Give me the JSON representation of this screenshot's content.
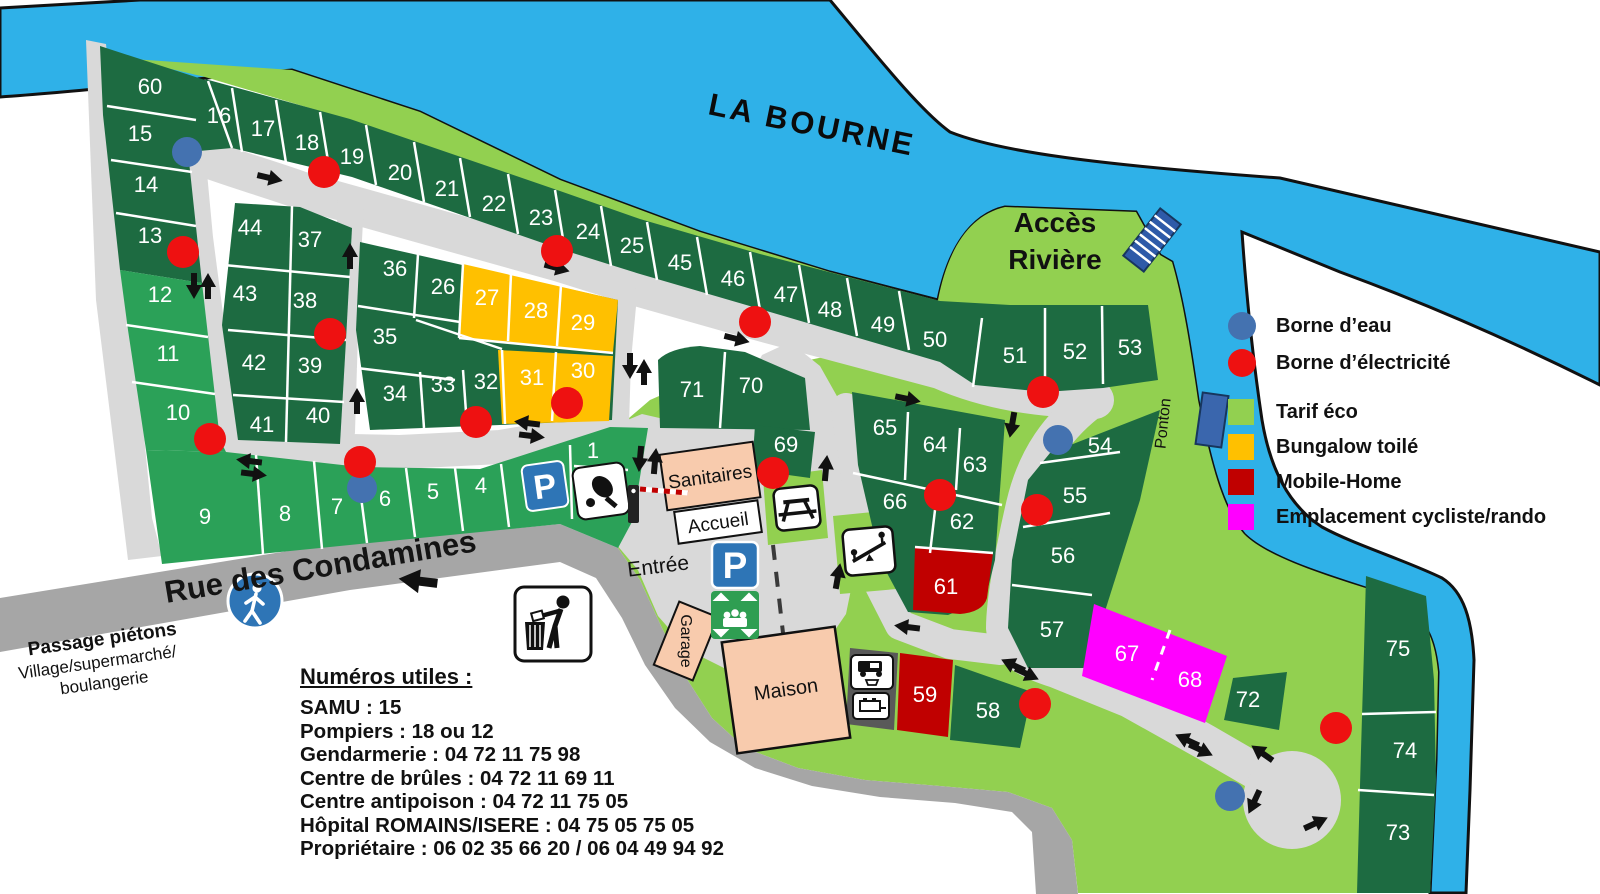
{
  "map": {
    "river_name": "LA BOURNE",
    "river_access_line1": "Accès",
    "river_access_line2": "Rivière",
    "ponton_label": "Ponton",
    "street_name": "Rue des Condamines",
    "pedestrian_crossing_title": "Passage piétons",
    "pedestrian_crossing_line1": "Village/supermarché/",
    "pedestrian_crossing_line2": "boulangerie",
    "entrance_label": "Entrée",
    "buildings": {
      "sanitaires": "Sanitaires",
      "accueil": "Accueil",
      "garage": "Garage",
      "maison": "Maison"
    }
  },
  "legend": {
    "items": [
      {
        "label": "Borne d’eau",
        "shape": "circle",
        "color": "#4472b0"
      },
      {
        "label": "Borne d’électricité",
        "shape": "circle",
        "color": "#ee1111"
      },
      {
        "label": "Tarif éco",
        "shape": "square",
        "color": "#92d050"
      },
      {
        "label": "Bungalow toilé",
        "shape": "square",
        "color": "#ffc000"
      },
      {
        "label": "Mobile-Home",
        "shape": "square",
        "color": "#c00000"
      },
      {
        "label": "Emplacement cycliste/rando",
        "shape": "square",
        "color": "#ff00ff"
      }
    ]
  },
  "useful_numbers": {
    "title": "Numéros utiles :",
    "lines": [
      "SAMU : 15",
      "Pompiers : 18 ou 12",
      "Gendarmerie : 04 72 11 75 98",
      "Centre de brûles : 04 72 11 69 11",
      "Centre antipoison : 04 72 11 75 05",
      "Hôpital ROMAINS/ISERE : 04 75 05 75 05",
      "Propriétaire : 06 02 35 66 20 / 06 04 49 94 92"
    ]
  },
  "plots": [
    {
      "n": "1",
      "x": 593,
      "y": 458,
      "category": "medium"
    },
    {
      "n": "4",
      "x": 481,
      "y": 493,
      "category": "medium"
    },
    {
      "n": "5",
      "x": 433,
      "y": 499,
      "category": "medium"
    },
    {
      "n": "6",
      "x": 385,
      "y": 506,
      "category": "medium"
    },
    {
      "n": "7",
      "x": 337,
      "y": 514,
      "category": "medium"
    },
    {
      "n": "8",
      "x": 285,
      "y": 521,
      "category": "medium"
    },
    {
      "n": "9",
      "x": 205,
      "y": 524,
      "category": "medium"
    },
    {
      "n": "10",
      "x": 178,
      "y": 420,
      "category": "medium"
    },
    {
      "n": "11",
      "x": 168,
      "y": 361,
      "category": "medium"
    },
    {
      "n": "12",
      "x": 160,
      "y": 302,
      "category": "medium"
    },
    {
      "n": "13",
      "x": 150,
      "y": 243,
      "category": "standard"
    },
    {
      "n": "14",
      "x": 146,
      "y": 192,
      "category": "standard"
    },
    {
      "n": "15",
      "x": 140,
      "y": 141,
      "category": "standard"
    },
    {
      "n": "16",
      "x": 219,
      "y": 123,
      "category": "standard"
    },
    {
      "n": "17",
      "x": 263,
      "y": 136,
      "category": "standard"
    },
    {
      "n": "18",
      "x": 307,
      "y": 150,
      "category": "standard"
    },
    {
      "n": "19",
      "x": 352,
      "y": 164,
      "category": "standard"
    },
    {
      "n": "20",
      "x": 400,
      "y": 180,
      "category": "standard"
    },
    {
      "n": "21",
      "x": 447,
      "y": 196,
      "category": "standard"
    },
    {
      "n": "22",
      "x": 494,
      "y": 211,
      "category": "standard"
    },
    {
      "n": "23",
      "x": 541,
      "y": 225,
      "category": "standard"
    },
    {
      "n": "24",
      "x": 588,
      "y": 239,
      "category": "standard"
    },
    {
      "n": "25",
      "x": 632,
      "y": 253,
      "category": "standard"
    },
    {
      "n": "26",
      "x": 443,
      "y": 294,
      "category": "standard"
    },
    {
      "n": "27",
      "x": 487,
      "y": 305,
      "category": "bungalow"
    },
    {
      "n": "28",
      "x": 536,
      "y": 318,
      "category": "bungalow"
    },
    {
      "n": "29",
      "x": 583,
      "y": 330,
      "category": "bungalow"
    },
    {
      "n": "30",
      "x": 583,
      "y": 378,
      "category": "bungalow"
    },
    {
      "n": "31",
      "x": 532,
      "y": 385,
      "category": "bungalow"
    },
    {
      "n": "32",
      "x": 486,
      "y": 389,
      "category": "standard"
    },
    {
      "n": "33",
      "x": 443,
      "y": 392,
      "category": "standard"
    },
    {
      "n": "34",
      "x": 395,
      "y": 401,
      "category": "standard"
    },
    {
      "n": "35",
      "x": 385,
      "y": 344,
      "category": "standard"
    },
    {
      "n": "36",
      "x": 395,
      "y": 276,
      "category": "standard"
    },
    {
      "n": "37",
      "x": 310,
      "y": 247,
      "category": "standard"
    },
    {
      "n": "38",
      "x": 305,
      "y": 308,
      "category": "standard"
    },
    {
      "n": "39",
      "x": 310,
      "y": 373,
      "category": "standard"
    },
    {
      "n": "40",
      "x": 318,
      "y": 423,
      "category": "standard"
    },
    {
      "n": "41",
      "x": 262,
      "y": 432,
      "category": "standard"
    },
    {
      "n": "42",
      "x": 254,
      "y": 370,
      "category": "standard"
    },
    {
      "n": "43",
      "x": 245,
      "y": 301,
      "category": "standard"
    },
    {
      "n": "44",
      "x": 250,
      "y": 235,
      "category": "standard"
    },
    {
      "n": "45",
      "x": 680,
      "y": 270,
      "category": "standard"
    },
    {
      "n": "46",
      "x": 733,
      "y": 286,
      "category": "standard"
    },
    {
      "n": "47",
      "x": 786,
      "y": 302,
      "category": "standard"
    },
    {
      "n": "48",
      "x": 830,
      "y": 317,
      "category": "standard"
    },
    {
      "n": "49",
      "x": 883,
      "y": 332,
      "category": "standard"
    },
    {
      "n": "50",
      "x": 935,
      "y": 347,
      "category": "standard"
    },
    {
      "n": "51",
      "x": 1015,
      "y": 363,
      "category": "standard"
    },
    {
      "n": "52",
      "x": 1075,
      "y": 359,
      "category": "standard"
    },
    {
      "n": "53",
      "x": 1130,
      "y": 355,
      "category": "standard"
    },
    {
      "n": "54",
      "x": 1100,
      "y": 453,
      "category": "standard"
    },
    {
      "n": "55",
      "x": 1075,
      "y": 503,
      "category": "standard"
    },
    {
      "n": "56",
      "x": 1063,
      "y": 563,
      "category": "standard"
    },
    {
      "n": "57",
      "x": 1052,
      "y": 637,
      "category": "standard"
    },
    {
      "n": "58",
      "x": 988,
      "y": 718,
      "category": "standard"
    },
    {
      "n": "59",
      "x": 925,
      "y": 702,
      "category": "mobile"
    },
    {
      "n": "60",
      "x": 150,
      "y": 94,
      "category": "standard"
    },
    {
      "n": "61",
      "x": 946,
      "y": 594,
      "category": "mobile"
    },
    {
      "n": "62",
      "x": 962,
      "y": 529,
      "category": "standard"
    },
    {
      "n": "63",
      "x": 975,
      "y": 472,
      "category": "standard"
    },
    {
      "n": "64",
      "x": 935,
      "y": 452,
      "category": "standard"
    },
    {
      "n": "65",
      "x": 885,
      "y": 435,
      "category": "standard"
    },
    {
      "n": "66",
      "x": 895,
      "y": 509,
      "category": "standard"
    },
    {
      "n": "67",
      "x": 1127,
      "y": 661,
      "category": "cyclo"
    },
    {
      "n": "68",
      "x": 1190,
      "y": 687,
      "category": "cyclo"
    },
    {
      "n": "69",
      "x": 786,
      "y": 452,
      "category": "standard"
    },
    {
      "n": "70",
      "x": 751,
      "y": 393,
      "category": "standard"
    },
    {
      "n": "71",
      "x": 692,
      "y": 397,
      "category": "standard"
    },
    {
      "n": "72",
      "x": 1248,
      "y": 707,
      "category": "standard"
    },
    {
      "n": "73",
      "x": 1398,
      "y": 840,
      "category": "standard"
    },
    {
      "n": "74",
      "x": 1405,
      "y": 758,
      "category": "standard"
    },
    {
      "n": "75",
      "x": 1398,
      "y": 656,
      "category": "standard"
    }
  ],
  "water_points": [
    {
      "x": 187,
      "y": 152
    },
    {
      "x": 362,
      "y": 488
    },
    {
      "x": 1058,
      "y": 440
    },
    {
      "x": 1230,
      "y": 796
    }
  ],
  "electric_points": [
    {
      "x": 324,
      "y": 172
    },
    {
      "x": 183,
      "y": 252
    },
    {
      "x": 557,
      "y": 251
    },
    {
      "x": 755,
      "y": 322
    },
    {
      "x": 1043,
      "y": 392
    },
    {
      "x": 330,
      "y": 334
    },
    {
      "x": 567,
      "y": 403
    },
    {
      "x": 476,
      "y": 422
    },
    {
      "x": 210,
      "y": 439
    },
    {
      "x": 360,
      "y": 462
    },
    {
      "x": 773,
      "y": 473
    },
    {
      "x": 940,
      "y": 495
    },
    {
      "x": 1037,
      "y": 510
    },
    {
      "x": 1035,
      "y": 704
    },
    {
      "x": 1336,
      "y": 728
    }
  ],
  "colors": {
    "river": "#2fb1e8",
    "grass": "#92d050",
    "plot_standard": "#1d6b41",
    "plot_medium": "#2ba158",
    "plot_bungalow": "#ffc000",
    "plot_mobile": "#c00000",
    "plot_cyclo": "#ff00ff",
    "road": "#d9d9d9",
    "street": "#a6a6a6",
    "water_dot": "#4472b0",
    "electric_dot": "#ee1111"
  }
}
